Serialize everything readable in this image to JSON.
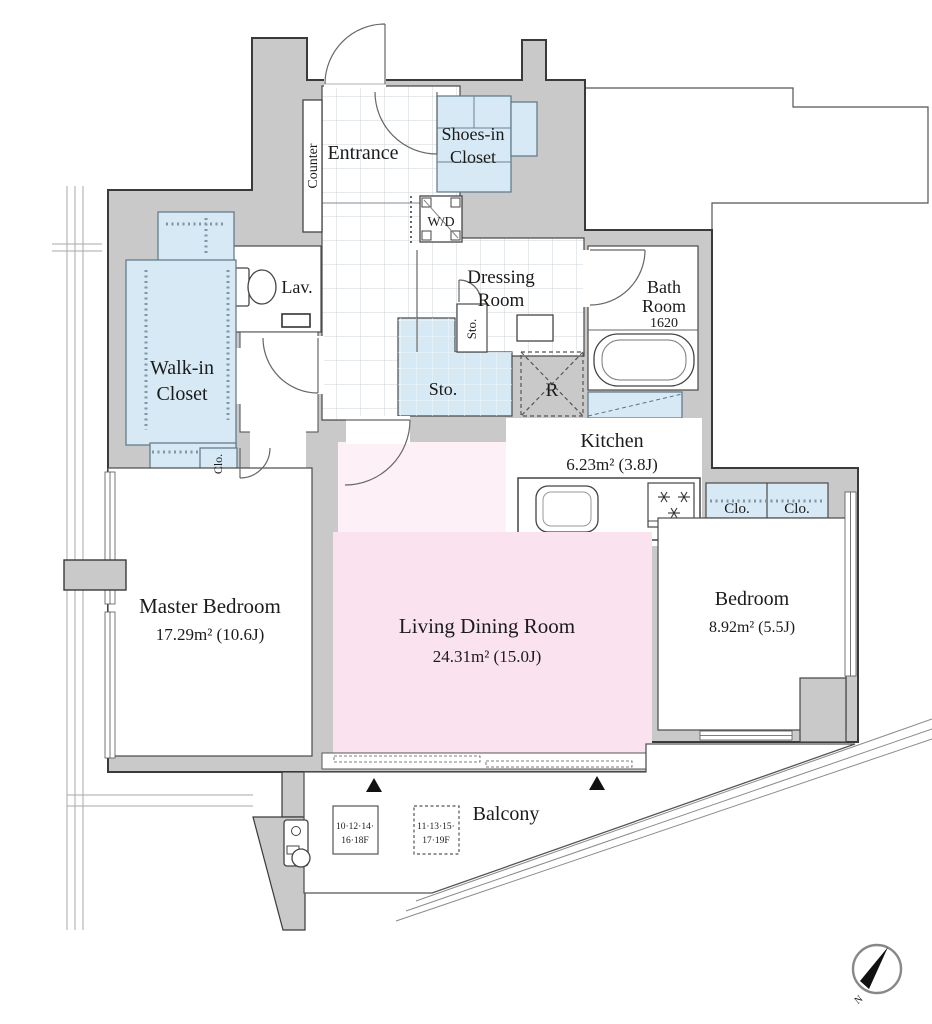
{
  "plan": {
    "rooms": {
      "entrance": {
        "label": "Entrance"
      },
      "counter": {
        "label": "Counter"
      },
      "shoes_closet": {
        "line1": "Shoes-in",
        "line2": "Closet"
      },
      "washer_dryer": {
        "label": "W/D"
      },
      "lavatory": {
        "label": "Lav."
      },
      "dressing": {
        "line1": "Dressing",
        "line2": "Room"
      },
      "bath": {
        "line1": "Bath",
        "line2": "Room",
        "size": "1620"
      },
      "storage_small": {
        "label": "Sto."
      },
      "storage_large": {
        "label": "Sto."
      },
      "refrigerator": {
        "label": "R"
      },
      "kitchen": {
        "name": "Kitchen",
        "area": "6.23m² (3.8J)"
      },
      "walk_in_closet": {
        "line1": "Walk-in",
        "line2": "Closet"
      },
      "closet_hall": {
        "label": "Clo."
      },
      "closet_bed_1": {
        "label": "Clo."
      },
      "closet_bed_2": {
        "label": "Clo."
      },
      "master_bedroom": {
        "name": "Master Bedroom",
        "area": "17.29m² (10.6J)"
      },
      "living_dining": {
        "name": "Living Dining Room",
        "area": "24.31m² (15.0J)"
      },
      "bedroom": {
        "name": "Bedroom",
        "area": "8.92m² (5.5J)"
      },
      "balcony": {
        "label": "Balcony"
      }
    },
    "floor_tags": {
      "solid": {
        "line1": "10·12·14·",
        "line2": "16·18F"
      },
      "dashed": {
        "line1": "11·13·15·",
        "line2": "17·19F"
      }
    },
    "compass": {
      "label": "N"
    },
    "colors": {
      "wall": "#c9c9c9",
      "closet": "#d6e9f4",
      "living": "#fae3ee",
      "living_light": "#fdf0f6",
      "line": "#3a3a3a"
    }
  }
}
